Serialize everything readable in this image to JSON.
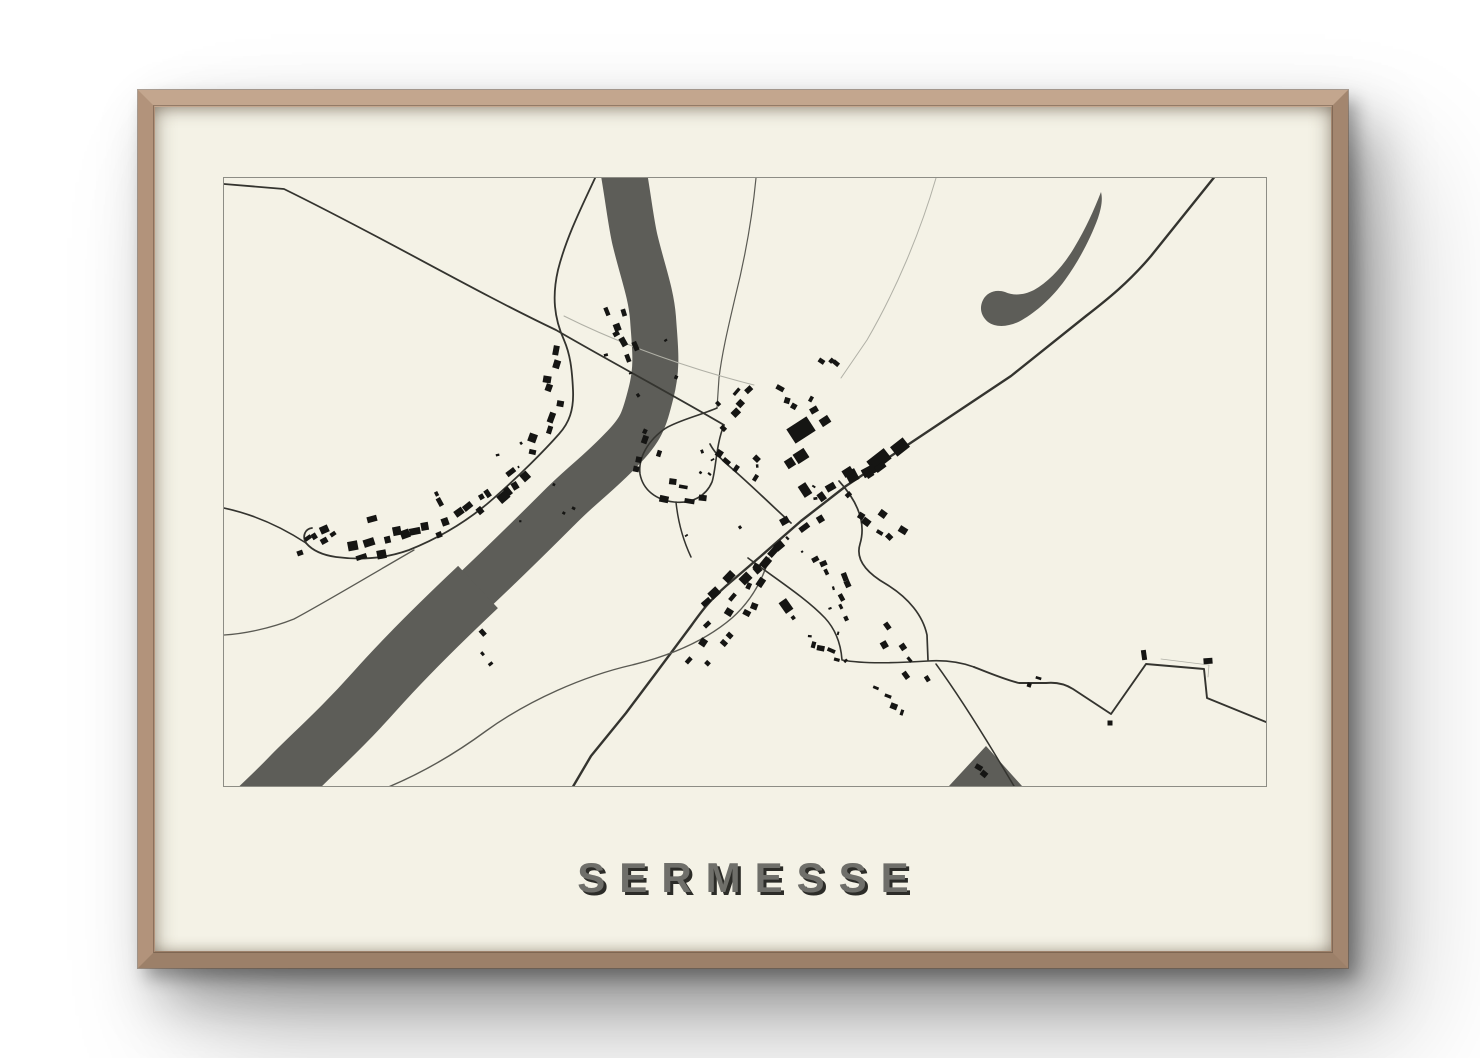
{
  "poster": {
    "title": "SERMESSE"
  },
  "colors": {
    "wall": "#ffffff",
    "frame_wood": "#b29478",
    "frame_wood_light": "#c3a68e",
    "frame_wood_dark": "#9c8069",
    "poster_bg": "#f4f2e6",
    "map_border": "#8d8d85",
    "water": "#5d5d58",
    "road_dark": "#34342f",
    "road_mid": "#5a5a53",
    "road_light": "#b0b0a6",
    "building": "#151513",
    "title_fill": "#6f6f6a",
    "title_shadow": "#2c2c28"
  },
  "map": {
    "width": 1042,
    "height": 608,
    "water": {
      "river": [
        {
          "d": "M399,-10 C405,25 407,45 411,62 C419,95 427,115 429,140 C431,170 434,188 427,215 C420,243 417,252 397,272 C374,296 359,306 337,328 C309,356 289,376 254,409 C219,442 184,476 151,513 C118,550 94,571 69,596 C50,616 36,628 22,642",
          "w": 46
        },
        {
          "d": "M254,409 C219,442 184,476 151,513 C118,550 94,571 69,596 C50,616 34,630 18,646",
          "w": 58
        }
      ],
      "lake": "M877,14 C870,32 862,50 850,70 C838,90 824,104 810,112 C800,117 790,118 781,114 C772,111 763,114 759,122 C755,130 757,138 764,144 C772,150 786,149 798,142 C812,134 828,120 841,102 C854,84 866,62 874,40 C877,31 879,22 877,14 Z",
      "lake_slit": "M866,32 L847,63",
      "triangle": "M762,568 L798,608 L725,608 Z"
    },
    "roads": [
      {
        "d": "M992,-3 L927,78 C905,104 884,121 862,138 L787,198 L727,238 L667,278 L622,308 L577,343 L537,378 L502,408 C485,423 477,434 467,448 L432,495 L402,535 L367,578 L347,612",
        "w": 2.4,
        "t": "dark"
      },
      {
        "d": "M0,6 L60,11 C160,60 248,112 332,152 C380,180 440,212 500,247",
        "w": 1.8,
        "t": "dark"
      },
      {
        "d": "M372,-2 C358,28 342,60 334,92 C328,118 330,140 340,162 C346,176 348,190 349,212 C350,232 345,245 335,256 C320,273 295,298 270,320 C243,344 215,360 185,372 C160,381 135,382 112,379 C98,377 88,372 82,365 C78,358 81,351 88,350",
        "w": 1.8,
        "t": "dark"
      },
      {
        "d": "M0,330 C28,336 56,348 82,365",
        "w": 1.6,
        "t": "dark"
      },
      {
        "d": "M190,372 C150,395 100,425 70,441 C45,451 18,456 0,457",
        "w": 1.3,
        "t": "mid"
      },
      {
        "d": "M532,0 C528,42 521,80 511,120 C504,150 498,175 495,200 L493,230",
        "w": 1.2,
        "t": "mid"
      },
      {
        "d": "M712,0 C696,55 672,112 643,162 L617,200",
        "w": 1,
        "t": "light"
      },
      {
        "d": "M493,230 C474,238 456,242 442,250 C424,262 414,280 416,296 C419,312 432,322 450,324 C468,326 482,318 488,304 C492,292 492,266 500,247",
        "w": 1.6,
        "t": "dark"
      },
      {
        "d": "M567,345 C545,325 525,305 505,288 C498,282 490,274 486,266",
        "w": 1.7,
        "t": "dark"
      },
      {
        "d": "M452,324 C454,344 459,362 467,379",
        "w": 1.5,
        "t": "dark"
      },
      {
        "d": "M545,380 C538,404 526,424 508,440 C480,464 445,478 408,487 C360,498 305,522 262,553 C228,578 196,596 162,610",
        "w": 1.4,
        "t": "mid"
      },
      {
        "d": "M615,303 C635,325 642,346 636,366 C631,382 643,395 662,406 C685,420 699,438 703,457 L704,482",
        "w": 1.7,
        "t": "dark"
      },
      {
        "d": "M524,380 C552,401 582,420 601,440 C613,453 617,468 618,482 C640,486 670,485 704,483 C720,482 736,484 750,489",
        "w": 1.6,
        "t": "dark"
      },
      {
        "d": "M750,489 C765,495 782,502 795,505 L822,505 C832,504 841,506 849,511 L887,536 L922,486 L980,491 L983,520 L1042,544",
        "w": 1.9,
        "t": "dark"
      },
      {
        "d": "M712,486 C728,508 752,545 772,578 L790,608",
        "w": 1.5,
        "t": "dark"
      },
      {
        "d": "M340,138 C400,168 470,192 530,207",
        "w": 1,
        "t": "light"
      },
      {
        "d": "M937,481 L985,487 L984,499",
        "w": 0.8,
        "t": "light"
      }
    ],
    "buildings": [
      [
        577,
        252,
        24,
        17,
        -33
      ],
      [
        601,
        243,
        10,
        8,
        -33
      ],
      [
        577,
        278,
        13,
        11,
        -33
      ],
      [
        655,
        282,
        22,
        13,
        -38
      ],
      [
        676,
        269,
        16,
        12,
        -38
      ],
      [
        645,
        293,
        14,
        9,
        -28
      ],
      [
        628,
        298,
        11,
        12,
        -28
      ],
      [
        566,
        285,
        9,
        9,
        -33
      ],
      [
        581,
        312,
        9,
        13,
        -33
      ],
      [
        562,
        428,
        9,
        13,
        -35
      ],
      [
        920,
        477,
        5,
        10,
        -8
      ],
      [
        984,
        483,
        9,
        6,
        -4
      ],
      [
        886,
        545,
        5,
        5,
        0
      ],
      [
        76,
        375,
        6,
        5,
        -20
      ],
      [
        148,
        341,
        10,
        6,
        -15
      ],
      [
        590,
        232,
        8,
        6,
        -30
      ]
    ],
    "strips": [
      [
        388,
        126,
        412,
        184,
        7,
        7,
        6
      ],
      [
        341,
        170,
        312,
        282,
        9,
        7,
        7
      ],
      [
        303,
        292,
        237,
        341,
        10,
        8,
        7
      ],
      [
        226,
        348,
        124,
        377,
        11,
        8,
        7
      ],
      [
        110,
        352,
        84,
        366,
        5,
        7,
        5
      ],
      [
        657,
        283,
        562,
        353,
        9,
        8,
        8
      ],
      [
        557,
        357,
        472,
        443,
        10,
        8,
        8
      ],
      [
        540,
        388,
        510,
        445,
        6,
        7,
        8
      ],
      [
        505,
        450,
        470,
        492,
        5,
        7,
        8
      ],
      [
        432,
        252,
        418,
        296,
        5,
        7,
        8
      ],
      [
        436,
        310,
        482,
        316,
        5,
        7,
        8
      ],
      [
        524,
        206,
        498,
        236,
        5,
        6,
        7
      ],
      [
        548,
        212,
        590,
        230,
        4,
        6,
        6
      ],
      [
        488,
        258,
        538,
        298,
        6,
        6,
        10
      ],
      [
        598,
        180,
        612,
        192,
        3,
        5,
        5
      ],
      [
        214,
        310,
        222,
        324,
        2,
        6,
        4
      ],
      [
        250,
        455,
        274,
        484,
        3,
        5,
        5
      ],
      [
        598,
        370,
        632,
        440,
        8,
        6,
        8
      ],
      [
        639,
        330,
        678,
        360,
        6,
        6,
        7
      ],
      [
        655,
        448,
        700,
        512,
        6,
        6,
        8
      ],
      [
        585,
        470,
        618,
        480,
        4,
        6,
        6
      ],
      [
        752,
        585,
        768,
        596,
        2,
        5,
        4
      ],
      [
        800,
        500,
        820,
        508,
        2,
        4,
        4
      ],
      [
        647,
        515,
        687,
        530,
        4,
        5,
        6
      ]
    ],
    "scatters": [
      {
        "cx": 520,
        "cy": 330,
        "r": 75,
        "n": 12,
        "s": 2.6
      },
      {
        "cx": 300,
        "cy": 310,
        "r": 55,
        "n": 7,
        "s": 2.6
      },
      {
        "cx": 620,
        "cy": 460,
        "r": 55,
        "n": 6,
        "s": 2.6
      },
      {
        "cx": 420,
        "cy": 180,
        "r": 40,
        "n": 5,
        "s": 2.6
      }
    ]
  }
}
